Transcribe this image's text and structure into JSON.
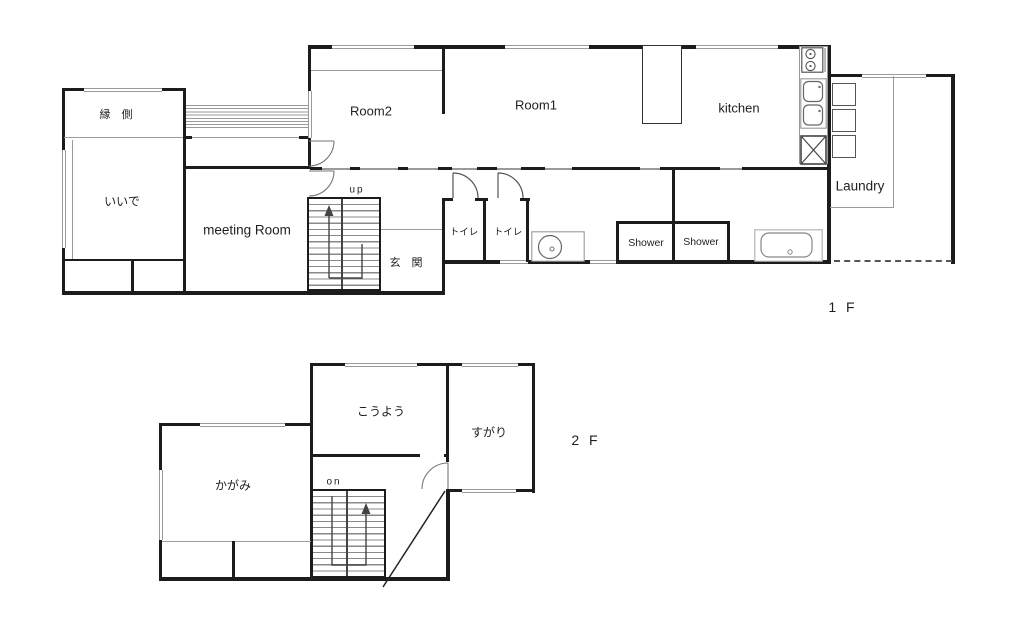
{
  "floor1": {
    "floor_label": "1 F",
    "rooms": {
      "engawa": "縁 側",
      "iide": "いいで",
      "meeting_room": "meeting Room",
      "room2": "Room2",
      "room1": "Room1",
      "kitchen": "kitchen",
      "genkan": "玄 関",
      "toilet_1": "トイレ",
      "toilet_2": "トイレ",
      "shower_1": "Shower",
      "shower_2": "Shower",
      "laundry": "Laundry"
    },
    "stair_direction_label": "up"
  },
  "floor2": {
    "floor_label": "2 F",
    "rooms": {
      "kagami": "かがみ",
      "kouyou": "こうよう",
      "sugari": "すがり"
    },
    "stair_direction_label": "on"
  },
  "colors": {
    "wall": "#1c1c1c",
    "thin_line": "#9a9a9a",
    "window_line": "#9a9a9a",
    "fixture_line": "#555555",
    "background": "#ffffff"
  }
}
